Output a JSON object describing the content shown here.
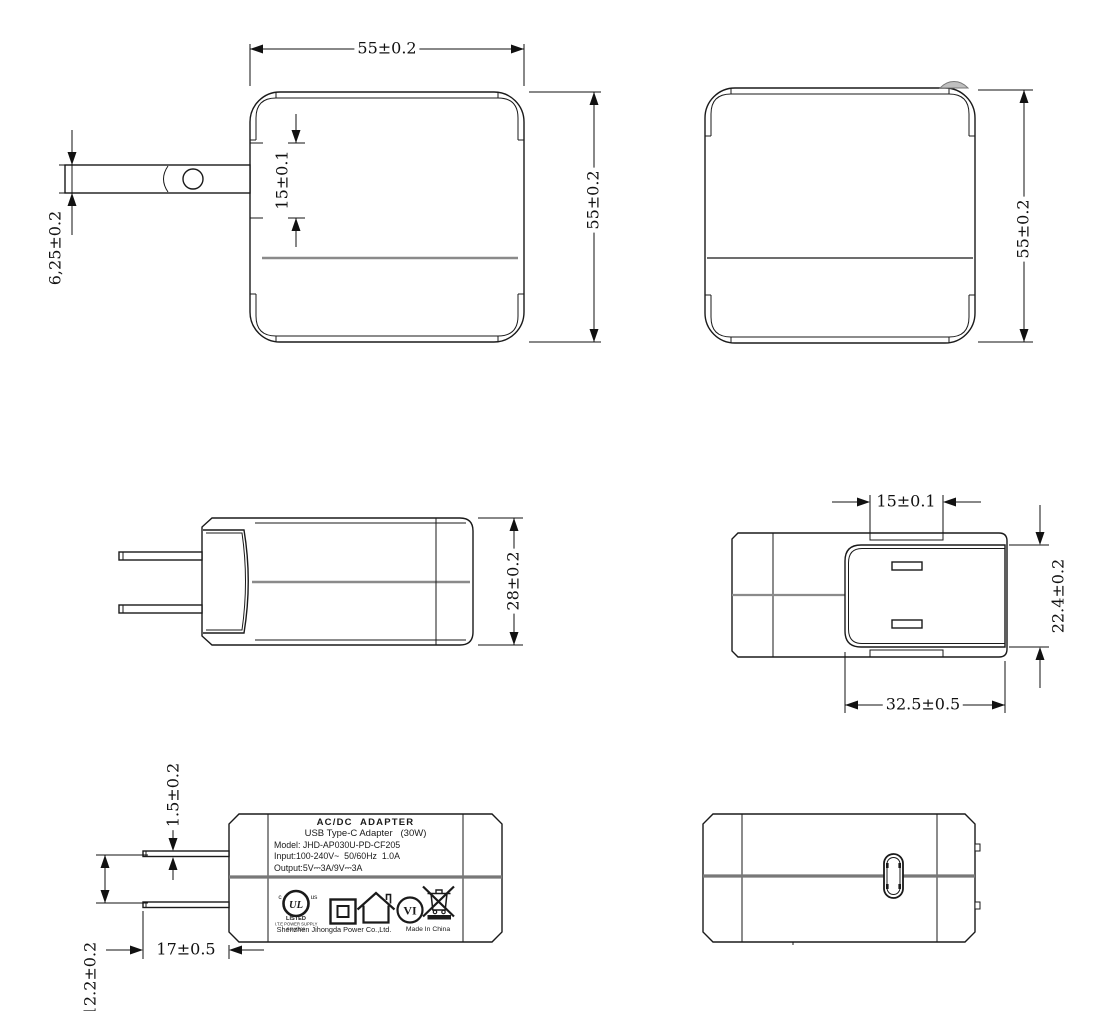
{
  "drawing": {
    "title": "AC/DC adapter outline drawing",
    "dims": {
      "front_width": "55±0.2",
      "front_height": "55±0.2",
      "front_blade_span": "15±0.1",
      "front_blade_offset": "6,25±0.2",
      "back_height": "55±0.2",
      "side_height": "28±0.2",
      "top_blade_span": "15±0.1",
      "top_door_height": "22.4±0.2",
      "top_door_width": "32.5±0.5",
      "label_blade_thickness": "1.5±0.2",
      "label_blade_gap": "12.2±0.2",
      "label_blade_length": "17±0.5"
    },
    "label": {
      "line1": "AC/DC  ADAPTER",
      "line2": "USB Type-C Adapter   (30W)",
      "line3": "Model: JHD-AP030U-PD-CF205",
      "line4": "Input:100-240V~  50/60Hz  1.0A",
      "line5": "Output:5V⎓3A/9V⎓3A",
      "ul_c": "c",
      "ul_monogram": "UL",
      "ul_us": "us",
      "ul_listed": "LISTED",
      "ul_supply": "I.T.E POWER SUPPLY",
      "ul_number": "5SM1822",
      "efficiency_mark": "VI",
      "company": "Shenzhen Jihongda Power Co.,Ltd.",
      "origin": "Made In China"
    },
    "colors": {
      "line": "#1a1a1a",
      "seam": "#8a8a8a",
      "dim_text": "#111111"
    }
  }
}
